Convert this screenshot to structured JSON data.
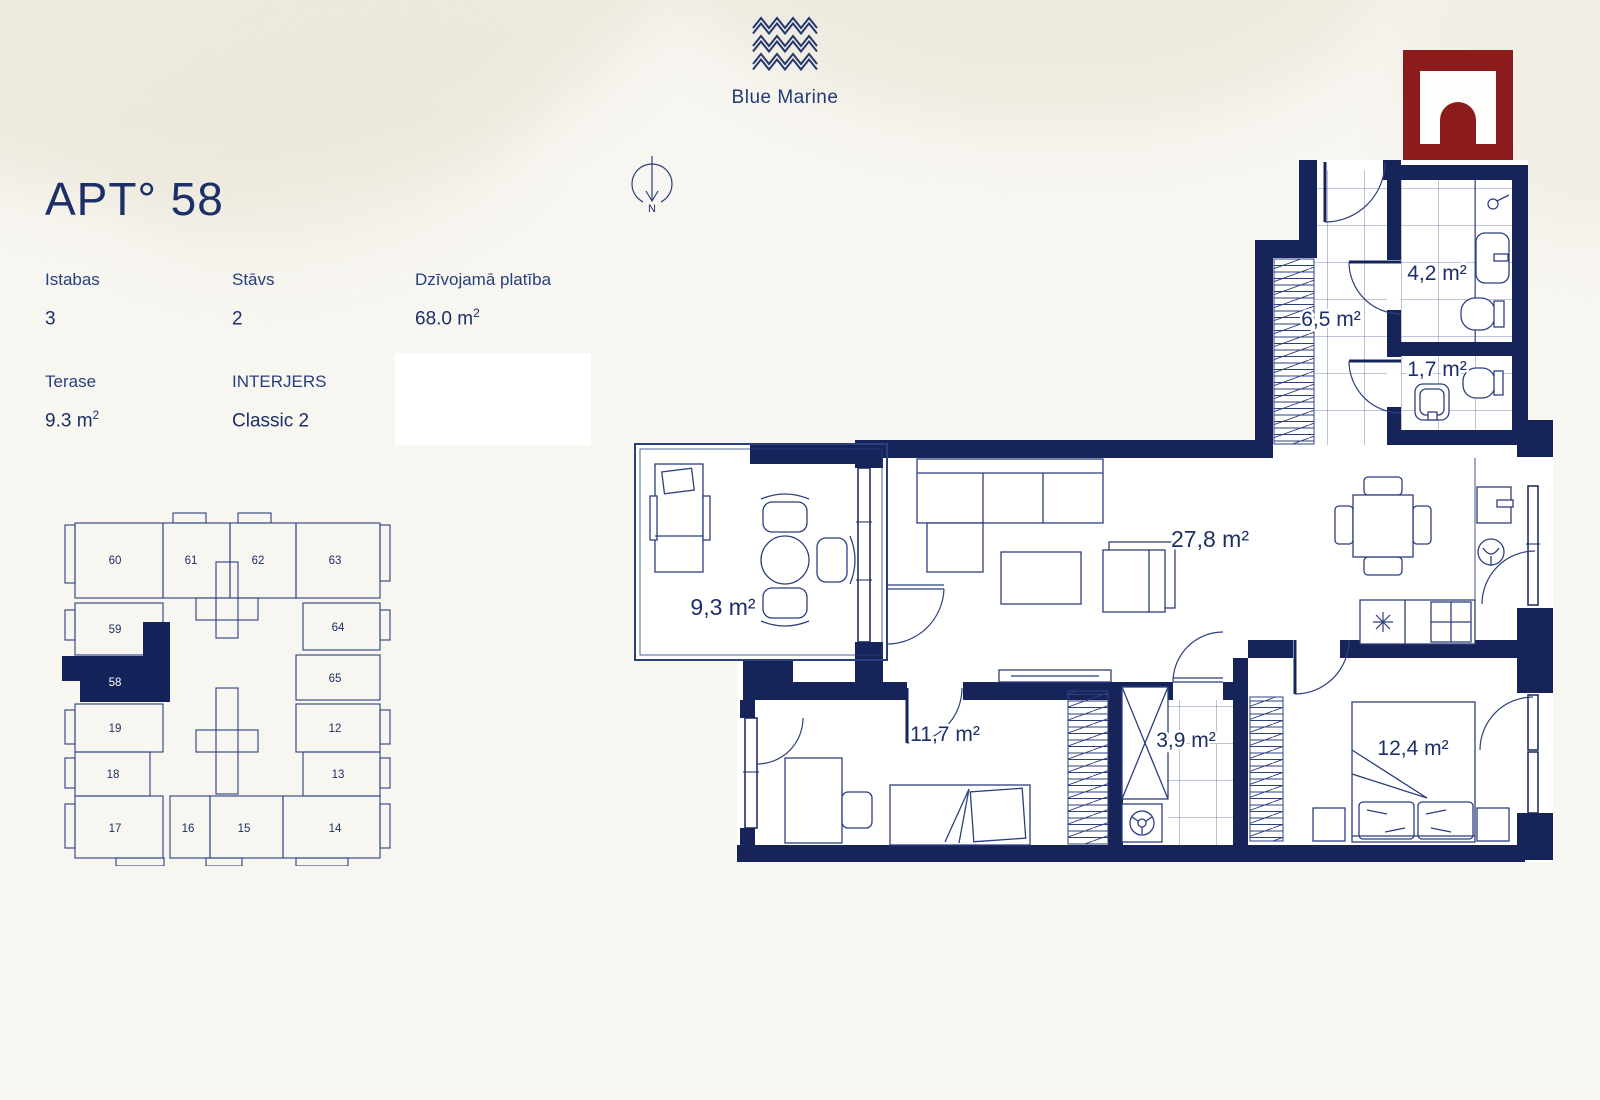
{
  "brand": {
    "name": "Blue Marine"
  },
  "apartment": {
    "title": "APT° 58",
    "specs": [
      {
        "label": "Istabas",
        "value": "3",
        "sup": ""
      },
      {
        "label": "Stāvs",
        "value": "2",
        "sup": ""
      },
      {
        "label": "Dzīvojamā platība",
        "value": "68.0 m",
        "sup": "2"
      },
      {
        "label": "Terase",
        "value": "9.3 m",
        "sup": "2"
      },
      {
        "label": "INTERJERS",
        "value": "Classic 2",
        "sup": ""
      }
    ]
  },
  "compass": {
    "label": "N"
  },
  "keyplan": {
    "highlighted_unit": "58",
    "units": [
      "60",
      "61",
      "62",
      "63",
      "59",
      "64",
      "58",
      "65",
      "19",
      "12",
      "18",
      "13",
      "17",
      "16",
      "15",
      "14"
    ]
  },
  "floorplan": {
    "rooms": [
      {
        "name": "hallway",
        "area": "6,5 m²"
      },
      {
        "name": "bathroom",
        "area": "4,2 m²"
      },
      {
        "name": "wc",
        "area": "1,7 m²"
      },
      {
        "name": "living-kitchen",
        "area": "27,8 m²"
      },
      {
        "name": "terrace",
        "area": "9,3 m²"
      },
      {
        "name": "bedroom-1",
        "area": "11,7 m²"
      },
      {
        "name": "utility",
        "area": "3,9 m²"
      },
      {
        "name": "bedroom-2",
        "area": "12,4 m²"
      }
    ]
  },
  "colors": {
    "navy": "#16245a",
    "ink": "#1e2f63",
    "red": "#8c1b1b",
    "cream": "#f8f6f1"
  }
}
